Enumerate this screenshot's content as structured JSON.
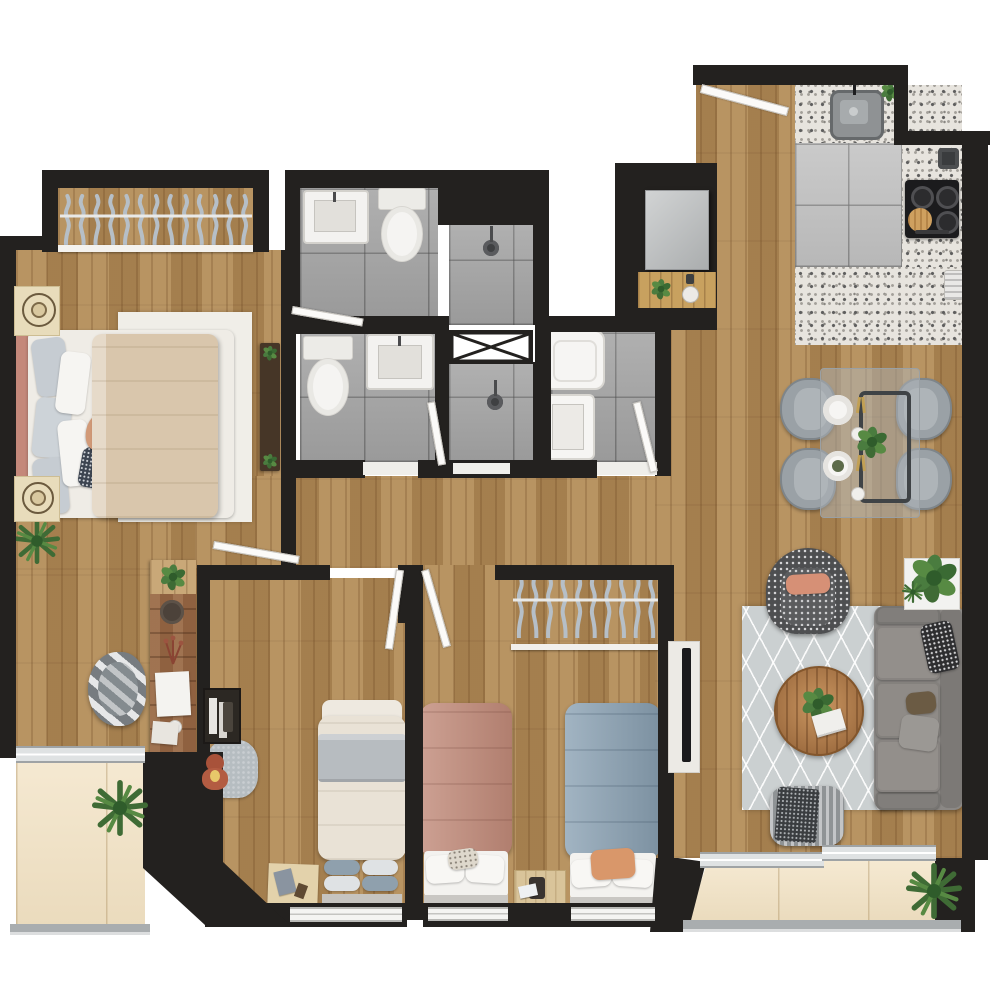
{
  "title": "Top-down 3D rendered floor plan of a 3-bedroom apartment with two balconies",
  "legend": {
    "wall_color": "#23211f",
    "wood_floor": "#b08a57",
    "bathroom_tile": "#a7a7a7",
    "kitchen_tile": "#c3c3c3",
    "terrazzo_counter": "#e7e4de",
    "balcony_deck": "#f2e2c3",
    "living_rug": "#cbd0d1"
  },
  "counts": {
    "master_closet_hangers": 13,
    "kids_closet_hangers": 10,
    "dining_chairs": 4,
    "cooktop_burners": 4,
    "sofa_seat_cushions": 3,
    "single_beds": 3,
    "bathrooms": 2,
    "balconies": 2
  },
  "rooms": [
    {
      "name": "Master bedroom",
      "floor": "wood",
      "contents": [
        "double bed with beige duvet and salmon headboard",
        "two cream nightstands with round lamps",
        "closet with hangers",
        "TV console with plants",
        "rustic writing desk with clock, papers and plant",
        "striped desk chair",
        "corner potted plant"
      ]
    },
    {
      "name": "Bathroom 1",
      "floor": "gray tile",
      "contents": [
        "washbasin",
        "toilet",
        "walk-in shower with shower head",
        "swing door"
      ]
    },
    {
      "name": "Bathroom 2",
      "floor": "gray tile",
      "contents": [
        "toilet",
        "washbasin",
        "walk-in shower with shower head",
        "swing door"
      ]
    },
    {
      "name": "Laundry room",
      "floor": "gray tile",
      "contents": [
        "washing machine",
        "utility sink",
        "swing door"
      ]
    },
    {
      "name": "Service shaft",
      "floor": "none",
      "contents": [
        "duct marked with X"
      ]
    },
    {
      "name": "Entry",
      "floor": "wood",
      "contents": [
        "entry swing door",
        "storage niche with gray cabinet",
        "wood shelf with plant and cup"
      ]
    },
    {
      "name": "Kitchen",
      "floor": "large gray tile with terrazzo counters",
      "contents": [
        "undermount sink with faucet",
        "4-burner gas cooktop",
        "round cutting board",
        "pot",
        "espresso maker",
        "small plant"
      ]
    },
    {
      "name": "Dining area",
      "floor": "wood",
      "contents": [
        "glass dining table with dark frame",
        "4 gray upholstered chairs",
        "two place settings with gold cutlery",
        "centerpiece plant"
      ]
    },
    {
      "name": "Living room",
      "floor": "wood",
      "contents": [
        "patterned rug",
        "3-seat gray sofa with pillows",
        "black-and-white patterned armchair with salmon pillow",
        "round wooden coffee table with plant and book",
        "knit pouf with fringed throw",
        "white TV console with TV",
        "planter box with large plant"
      ]
    },
    {
      "name": "Bedroom 2",
      "floor": "wood",
      "contents": [
        "single bed with cream duvet and gray band",
        "wall niche shelf with books",
        "gray play rug with teddy bear",
        "beige play mat with toys"
      ]
    },
    {
      "name": "Bedroom 3 (kids)",
      "floor": "wood",
      "contents": [
        "open closet with hangers",
        "single bed with pink duvet",
        "single bed with blue duvet and orange pillow",
        "shared beige nightstand with lamp and book",
        "wall-mounted TV"
      ]
    },
    {
      "name": "Master balcony",
      "floor": "cream deck",
      "contents": [
        "potted plant",
        "sliding glass door",
        "glass railing"
      ]
    },
    {
      "name": "Main balcony",
      "floor": "cream deck",
      "contents": [
        "potted plant",
        "sliding glass door",
        "glass railing"
      ]
    }
  ],
  "accent_colors": {
    "master_duvet": "#d9c6ac",
    "master_headboard": "#c4887a",
    "pink_bed": "#c08978",
    "blue_bed": "#8aa1b3",
    "bedroom2_band": "#b7bcc0",
    "salmon_pillow": "#d69076",
    "sofa_gray": "#8b8885",
    "dining_chair_gray": "#9aa1a6",
    "teddy_bear": "#a8523a",
    "coffee_table_wood": "#a9703f",
    "desk_wood": "#8f6140",
    "hanger_gray": "#b6bfc7",
    "gold_cutlery": "#c2a054"
  }
}
